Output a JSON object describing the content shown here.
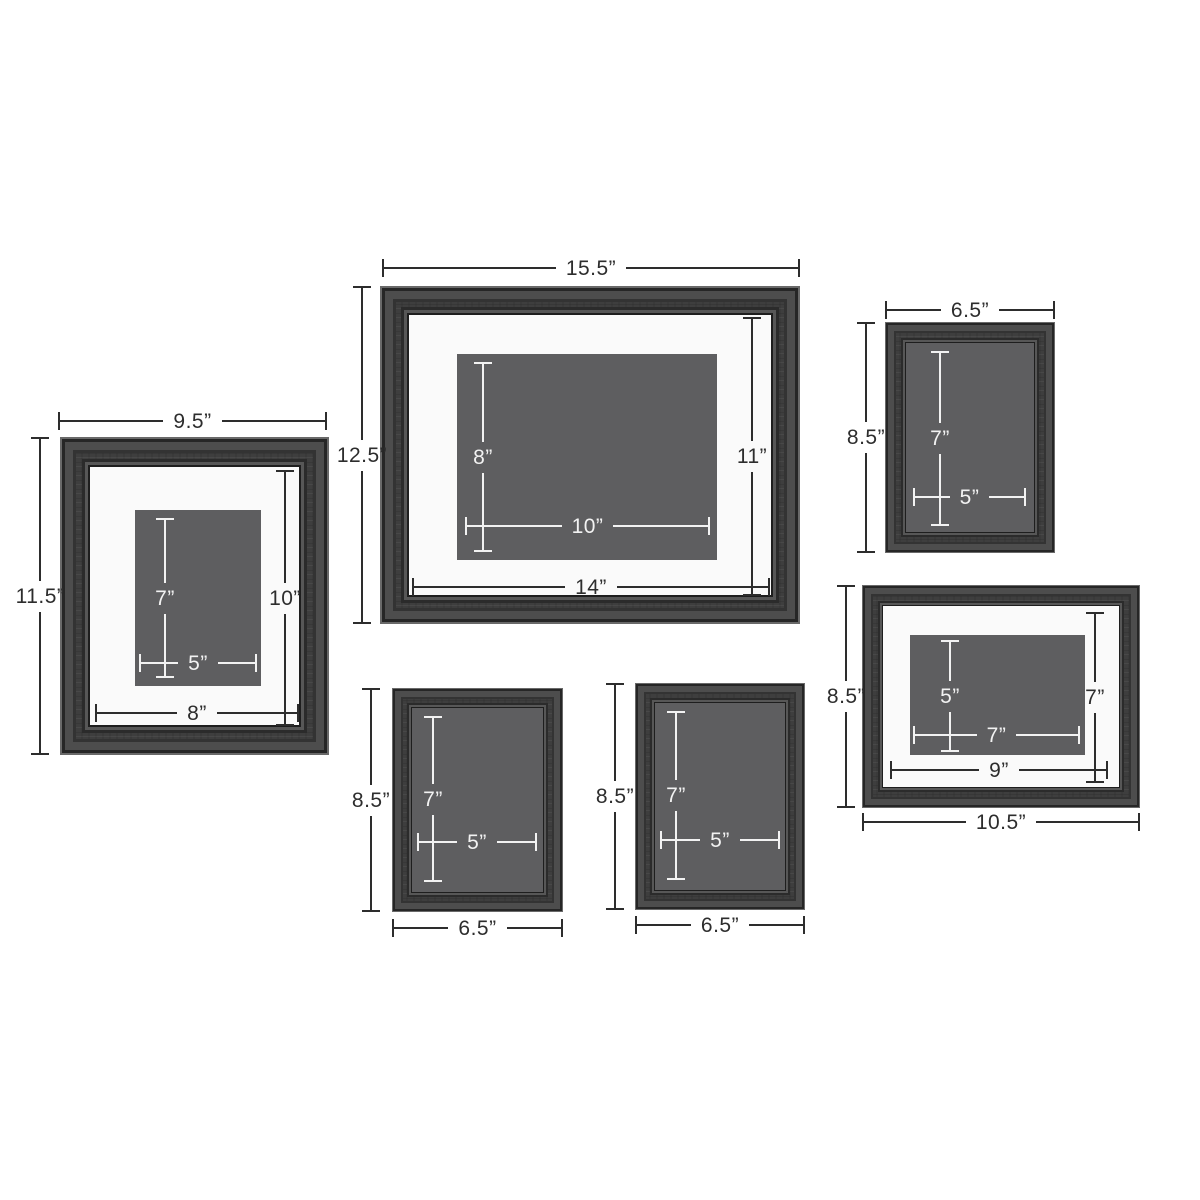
{
  "page": {
    "background": "#ffffff"
  },
  "colors": {
    "frame_wood": "#3e3e3e",
    "frame_wood_highlight": "#696969",
    "frame_wood_shadow": "#262626",
    "mat": "#fafafa",
    "photo_gray": "#5e5e60",
    "dim_dark": "#2d2d2d",
    "dim_light": "#f2f2f2"
  },
  "frames": [
    {
      "id": "left-portrait",
      "outer_width": "9.5”",
      "outer_height": "11.5”",
      "opening_width": "8”",
      "opening_height": "10”",
      "photo_width": "5”",
      "photo_height": "7”"
    },
    {
      "id": "center-landscape",
      "outer_width": "15.5”",
      "outer_height": "12.5”",
      "opening_width": "14”",
      "opening_height": "11”",
      "photo_width": "10”",
      "photo_height": "8”"
    },
    {
      "id": "top-right-portrait",
      "outer_width": "6.5”",
      "outer_height": "8.5”",
      "photo_width": "5”",
      "photo_height": "7”"
    },
    {
      "id": "bottom-left-portrait",
      "outer_width": "6.5”",
      "outer_height": "8.5”",
      "photo_width": "5”",
      "photo_height": "7”"
    },
    {
      "id": "bottom-middle-portrait",
      "outer_width": "6.5”",
      "outer_height": "8.5”",
      "photo_width": "5”",
      "photo_height": "7”"
    },
    {
      "id": "bottom-right-landscape",
      "outer_width": "10.5”",
      "outer_height": "8.5”",
      "opening_width": "9”",
      "opening_height": "7”",
      "photo_width": "7”",
      "photo_height": "5”"
    }
  ]
}
